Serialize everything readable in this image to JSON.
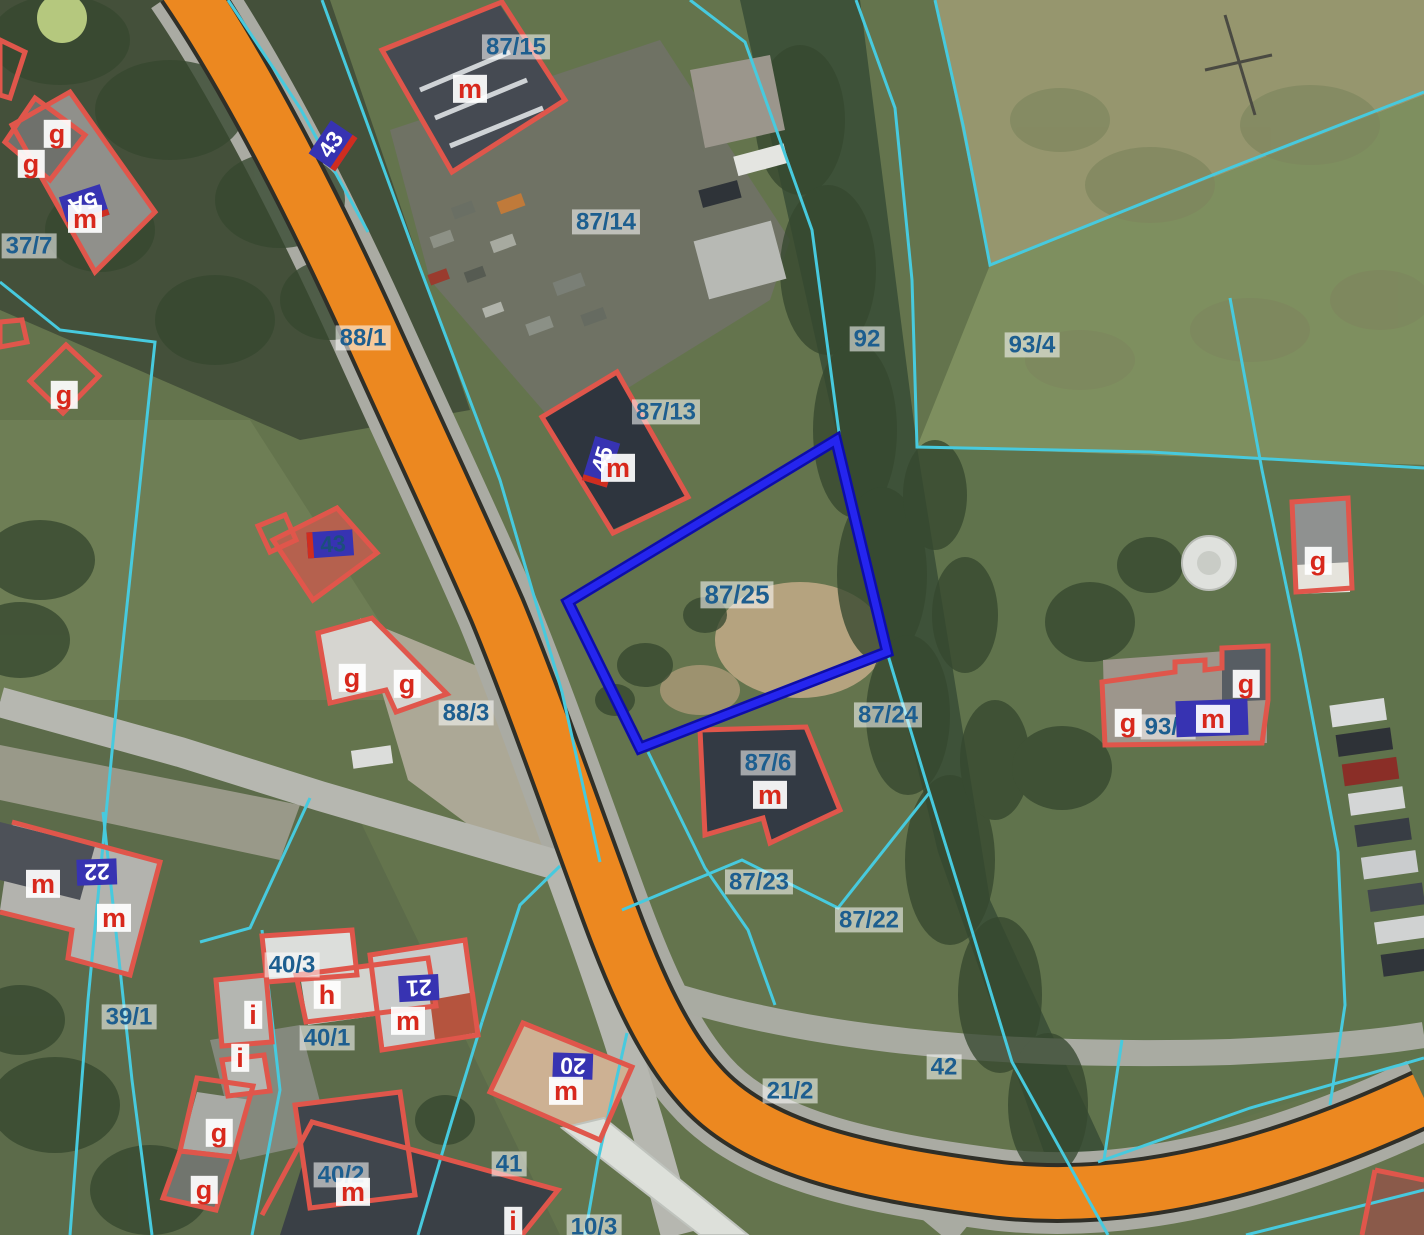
{
  "map": {
    "selected_parcel": "87/25",
    "parcel_labels": [
      "37/7",
      "88/1",
      "87/15",
      "87/14",
      "87/13",
      "92",
      "93/4",
      "87/25",
      "88/3",
      "87/24",
      "87/6",
      "87/23",
      "87/22",
      "93/3",
      "21/2",
      "42",
      "39/1",
      "40/3",
      "40/1",
      "41",
      "40/2",
      "10/3"
    ],
    "function_labels": [
      "g",
      "g",
      "m",
      "m",
      "g",
      "g",
      "g",
      "m",
      "g",
      "g",
      "g",
      "m",
      "m",
      "m",
      "m",
      "h",
      "i",
      "m",
      "i",
      "m",
      "g",
      "g",
      "m",
      "i"
    ],
    "address_plates": [
      "43",
      "5A",
      "43",
      "45",
      "",
      "22",
      "21",
      "20"
    ],
    "colors": {
      "parcel_boundary": "#47cade",
      "selected_parcel_outline": "#2020e8",
      "building_outline": "#e0564b",
      "road_fill": "#ec8820",
      "parcel_label_text": "#1d5e8f",
      "function_label_text": "#d8281c",
      "address_plate_bg": "#3733b2",
      "address_plate_text": "#ffffff"
    }
  }
}
